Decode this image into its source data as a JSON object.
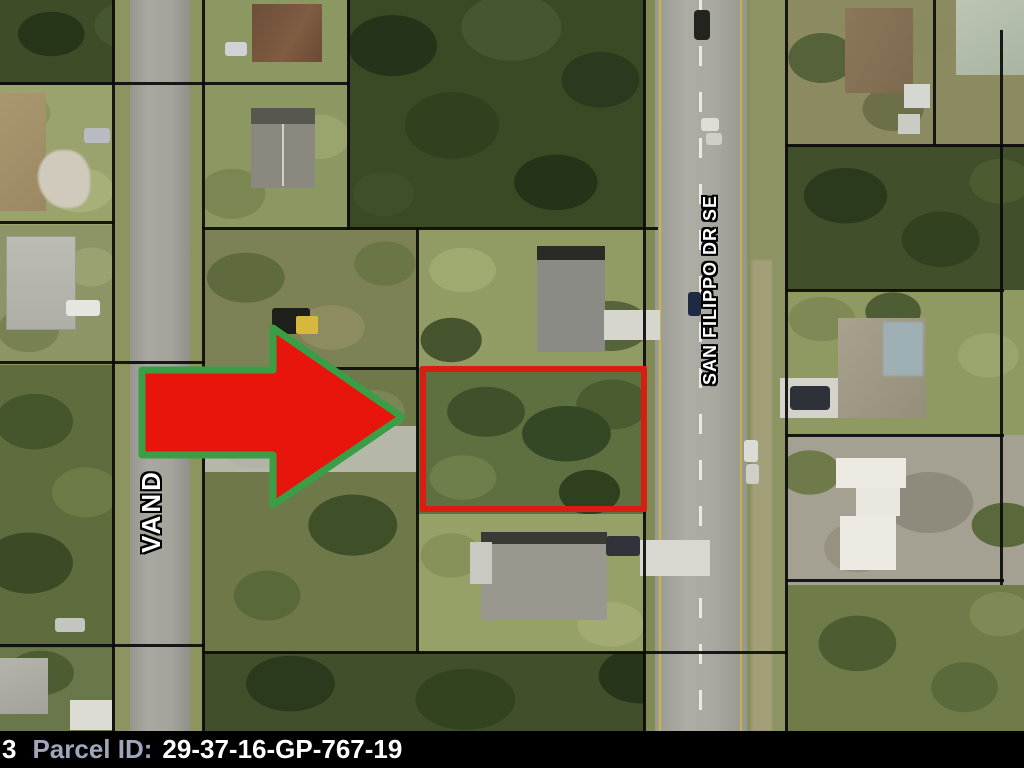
{
  "map": {
    "street_labels": [
      {
        "id": "san-filippo",
        "text": "SAN FILIPPO DR SE"
      },
      {
        "id": "vandolah-partial",
        "text": "VAND"
      }
    ],
    "highlight": {
      "arrow_fill": "#e8150c",
      "arrow_outline": "#3a9e47",
      "parcel_outline_color": "#d81e10"
    }
  },
  "footer": {
    "left_truncated_text": "3",
    "parcel_label": "Parcel ID:",
    "parcel_value": "29-37-16-GP-767-19",
    "label_color": "#9fa6ba",
    "value_color": "#ffffff"
  }
}
